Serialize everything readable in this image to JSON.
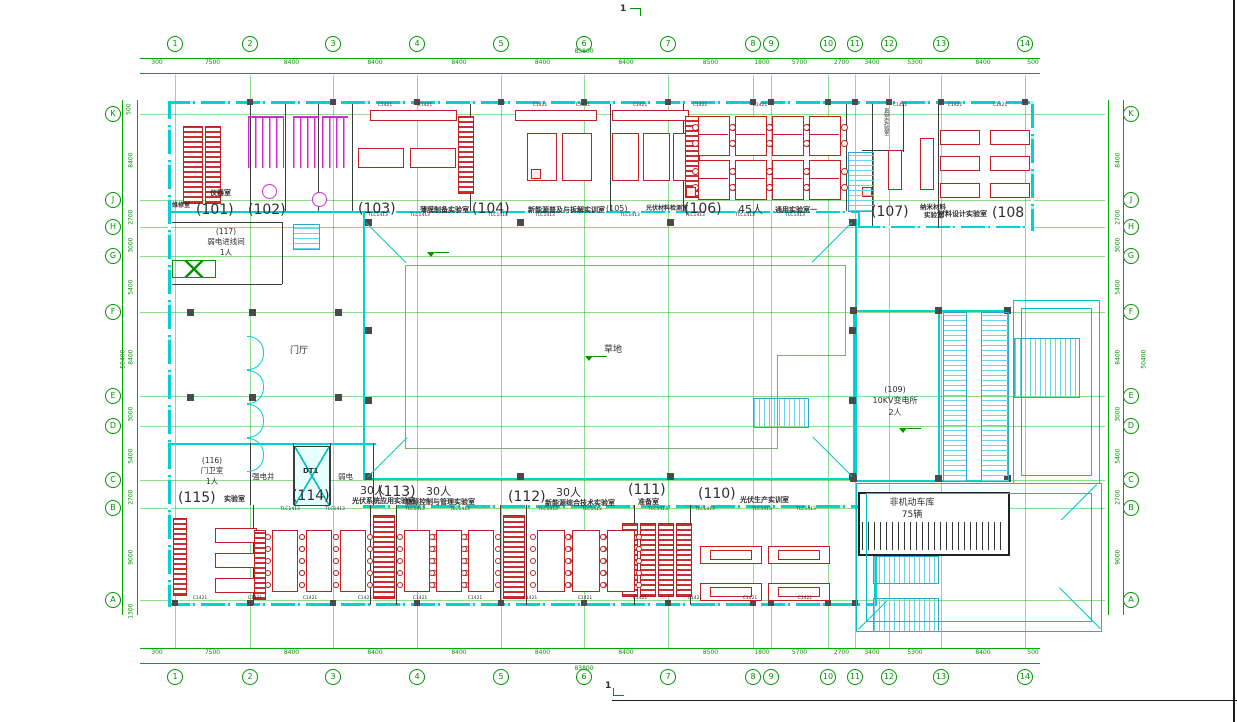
{
  "meta": {
    "section_marker": "1"
  },
  "colors": {
    "grid_green": "#009500",
    "wall_cyan": "#00d2d2",
    "furniture_red": "#c22020",
    "sanitary_magenta": "#d22ad2",
    "ink": "#2e2e2e"
  },
  "grid": {
    "top_labels": [
      "1",
      "2",
      "3",
      "4",
      "5",
      "6",
      "7",
      "8",
      "9",
      "10",
      "11",
      "12",
      "13",
      "14"
    ],
    "bottom_labels": [
      "1",
      "2",
      "3",
      "4",
      "5",
      "6",
      "7",
      "8",
      "9",
      "10",
      "11",
      "12",
      "13",
      "14"
    ],
    "left_labels": [
      "K",
      "J",
      "H",
      "G",
      "F",
      "E",
      "D",
      "C",
      "B",
      "A"
    ],
    "right_labels": [
      "K",
      "J",
      "H",
      "G",
      "F",
      "E",
      "D",
      "C",
      "B",
      "A"
    ]
  },
  "dimensions": {
    "top_segments": [
      "7500",
      "8400",
      "8400",
      "8400",
      "8400",
      "8400",
      "8500",
      "1800",
      "5700",
      "2700",
      "3400",
      "5300",
      "8400"
    ],
    "top_edge_left": "300",
    "top_edge_right": "500",
    "top_total": "83800",
    "side_segments": [
      "8400",
      "2700",
      "3000",
      "5400",
      "8400",
      "3000",
      "5400",
      "2700",
      "9000"
    ],
    "side_edge_top": "500",
    "side_edge_bottom": "1300",
    "side_total": "50400"
  },
  "rooms": [
    {
      "id": "101",
      "number": "(101)",
      "name": "",
      "capacity": ""
    },
    {
      "id": "102",
      "number": "(102)",
      "name": "",
      "capacity": ""
    },
    {
      "id": "103",
      "number": "(103)",
      "name": "薄膜制备实验室",
      "capacity": ""
    },
    {
      "id": "104",
      "number": "(104)",
      "name": "新能源普及与拆解实训室",
      "capacity": ""
    },
    {
      "id": "105",
      "number": "(105)",
      "name": "光伏材料检测室",
      "capacity": ""
    },
    {
      "id": "106",
      "number": "(106)",
      "name": "通用实验室一",
      "capacity": "45人"
    },
    {
      "id": "107",
      "number": "(107)",
      "name": "纳米材料实验室",
      "capacity": ""
    },
    {
      "id": "108",
      "number": "(108",
      "name": "材料设计实验室",
      "capacity": ""
    },
    {
      "id": "109",
      "number": "(109)",
      "name": "10KV变电所",
      "capacity": "2人"
    },
    {
      "id": "110",
      "number": "(110)",
      "name": "光伏生产实训室",
      "capacity": ""
    },
    {
      "id": "111",
      "number": "(111)",
      "name": "准备室",
      "capacity": ""
    },
    {
      "id": "112",
      "number": "(112)",
      "name": "新能源综合技术实验室",
      "capacity": "30人"
    },
    {
      "id": "113",
      "number": "(113)",
      "name": "能源控制与管理实验室",
      "capacity": "30人"
    },
    {
      "id": "114",
      "number": "(114)",
      "name": "光伏系统应用实验室",
      "capacity": "30人"
    },
    {
      "id": "115",
      "number": "(115)",
      "name": "实验室",
      "capacity": ""
    },
    {
      "id": "116",
      "number": "(116)",
      "name": "门卫室",
      "capacity": "1人"
    },
    {
      "id": "117",
      "number": "(117)",
      "name": "弱电进线间",
      "capacity": "1人"
    }
  ],
  "areas": {
    "lobby": "门厅",
    "lawn": "草地",
    "garage_name": "非机动车库",
    "garage_count": "75辆",
    "strong_shaft": "强电井",
    "elevator": "DT1",
    "weak_shaft": "弱电",
    "vacuum_lab": "真空实验室",
    "instrument_room": "仪器室",
    "repair_room": "维修室"
  },
  "window_tags": {
    "top": "C1421",
    "inner": "TLC1413"
  }
}
